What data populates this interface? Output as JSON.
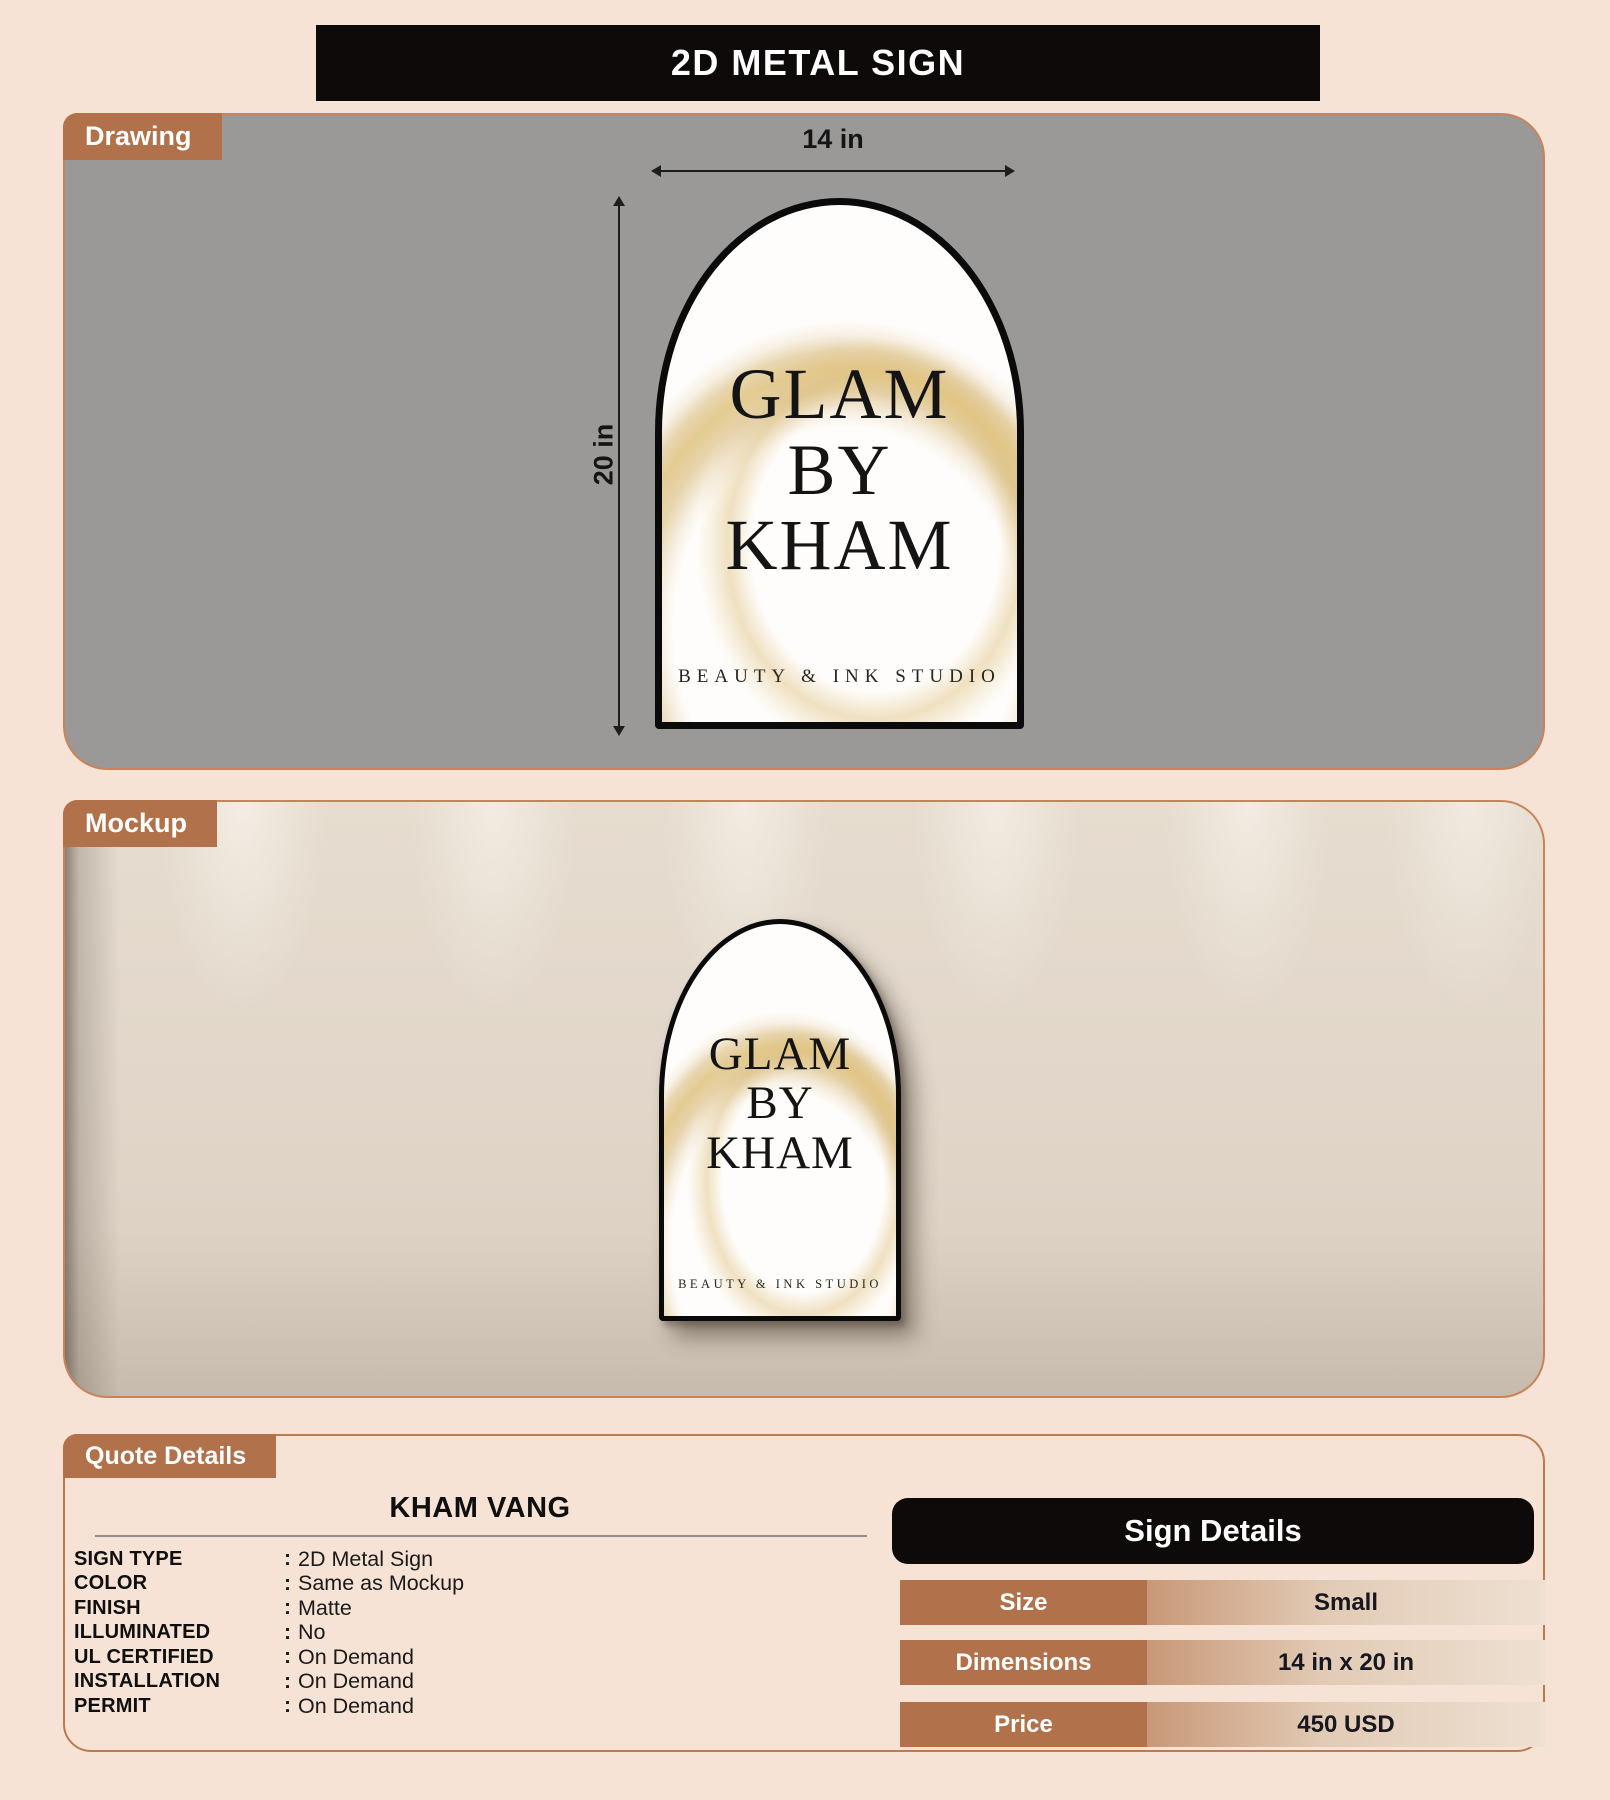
{
  "header": {
    "title": "2D METAL SIGN"
  },
  "drawing": {
    "tab_label": "Drawing",
    "width_dimension": "14 in",
    "height_dimension": "20 in",
    "sign": {
      "line1": "GLAM",
      "line2": "BY",
      "line3": "KHAM",
      "tagline": "BEAUTY & INK STUDIO"
    }
  },
  "mockup": {
    "tab_label": "Mockup",
    "sign": {
      "line1": "GLAM",
      "line2": "BY",
      "line3": "KHAM",
      "tagline": "BEAUTY & INK STUDIO"
    }
  },
  "quote": {
    "tab_label": "Quote Details",
    "customer_name": "KHAM VANG",
    "separator": ":",
    "fields": [
      {
        "label": "SIGN TYPE",
        "value": "2D Metal Sign"
      },
      {
        "label": "COLOR",
        "value": "Same as Mockup"
      },
      {
        "label": "FINISH",
        "value": "Matte"
      },
      {
        "label": "ILLUMINATED",
        "value": "No"
      },
      {
        "label": "UL CERTIFIED",
        "value": "On Demand"
      },
      {
        "label": "INSTALLATION",
        "value": "On Demand"
      },
      {
        "label": "PERMIT",
        "value": "On Demand"
      }
    ]
  },
  "sign_details": {
    "title": "Sign Details",
    "rows": [
      {
        "label": "Size",
        "value": "Small"
      },
      {
        "label": "Dimensions",
        "value": "14 in x 20 in"
      },
      {
        "label": "Price",
        "value": "450 USD"
      }
    ]
  },
  "colors": {
    "page_background": "#f7e3d5",
    "accent_brown": "#b1714b",
    "panel_gray": "#9a9998",
    "header_black": "#0d0a09",
    "gold_glitter": "#ddbe76"
  }
}
